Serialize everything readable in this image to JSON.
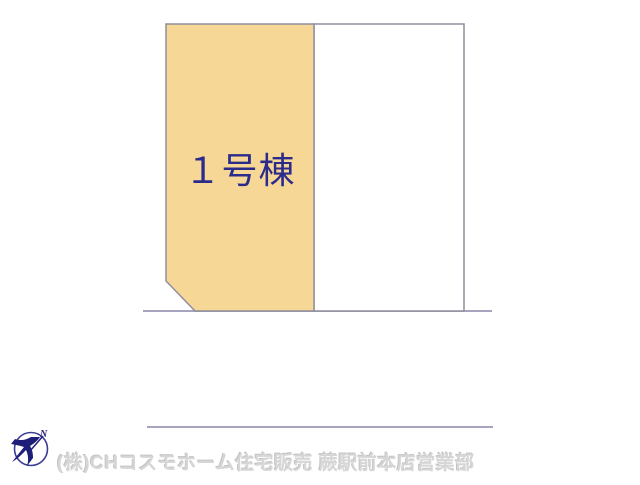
{
  "page": {
    "background": "#ffffff"
  },
  "plot_map": {
    "lots": [
      {
        "id": "lot-1",
        "label": "１号棟",
        "fill": "#F7D795",
        "label_color": "#2B2B8B"
      },
      {
        "id": "lot-2",
        "label": "",
        "fill": "#FFFFFF"
      }
    ],
    "lot_border_color": "#908E9E",
    "road_line_color": "#A6A4BE"
  },
  "footer": {
    "company": "(株)CHコスモホーム住宅販売 蕨駅前本店営業部",
    "company_color": "#D6D6D6",
    "compass": {
      "north_label": "N",
      "color": "#232380"
    }
  }
}
